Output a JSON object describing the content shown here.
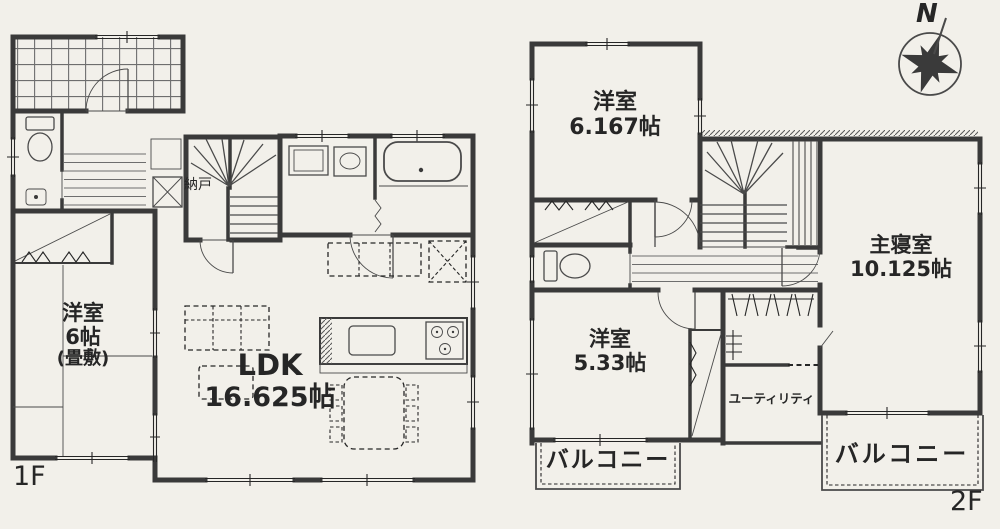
{
  "title": "間取り図",
  "colors": {
    "paper": "#f2f0ea",
    "wall": "#3a3a3a",
    "ink": "#262626"
  },
  "compass": {
    "label": "N"
  },
  "floor1": {
    "label": "1F",
    "nando": "納戸",
    "tatami_room": {
      "name": "洋室",
      "size": "6帖",
      "note": "(畳敷)"
    },
    "ldk": {
      "name": "LDK",
      "size": "16.625帖"
    }
  },
  "floor2": {
    "label": "2F",
    "bedroom_a": {
      "name": "洋室",
      "size": "6.167帖"
    },
    "master_bedroom": {
      "name": "主寝室",
      "size": "10.125帖"
    },
    "bedroom_b": {
      "name": "洋室",
      "size": "5.33帖"
    },
    "utility": {
      "name": "ユーティリティ"
    },
    "balcony_left": {
      "name": "バルコニー"
    },
    "balcony_right": {
      "name": "バルコニー"
    }
  }
}
